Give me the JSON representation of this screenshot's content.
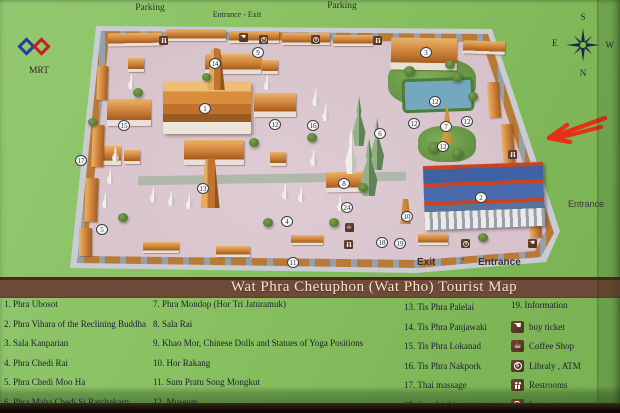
{
  "banner": {
    "title": "Wat Phra Chetuphon (Wat Pho) Tourist Map"
  },
  "map": {
    "labels": {
      "parking_left": "Parking",
      "entrance_exit_top": "Entrance - Exit",
      "parking_right": "Parking",
      "entrance_right": "Entrance",
      "exit_bottom": "Exit",
      "bottom_note": "7",
      "entrance_bottom": "Entrance",
      "mrt": "MRT"
    },
    "compass": {
      "top": "S",
      "left": "E",
      "right": "W",
      "bottom": "N"
    },
    "markers": [
      {
        "n": "1",
        "x": 205,
        "y": 108
      },
      {
        "n": "2",
        "x": 481,
        "y": 197
      },
      {
        "n": "3",
        "x": 426,
        "y": 52
      },
      {
        "n": "4",
        "x": 287,
        "y": 221
      },
      {
        "n": "5",
        "x": 102,
        "y": 229
      },
      {
        "n": "6",
        "x": 380,
        "y": 133
      },
      {
        "n": "7",
        "x": 446,
        "y": 126
      },
      {
        "n": "8",
        "x": 344,
        "y": 183
      },
      {
        "n": "9",
        "x": 258,
        "y": 52
      },
      {
        "n": "10",
        "x": 407,
        "y": 216
      },
      {
        "n": "11",
        "x": 293,
        "y": 262
      },
      {
        "n": "12",
        "x": 275,
        "y": 124
      },
      {
        "n": "12",
        "x": 435,
        "y": 101
      },
      {
        "n": "12",
        "x": 414,
        "y": 123
      },
      {
        "n": "12",
        "x": 467,
        "y": 121
      },
      {
        "n": "12",
        "x": 443,
        "y": 146
      },
      {
        "n": "13",
        "x": 203,
        "y": 188
      },
      {
        "n": "14",
        "x": 215,
        "y": 63
      },
      {
        "n": "15",
        "x": 124,
        "y": 125
      },
      {
        "n": "16",
        "x": 313,
        "y": 125
      },
      {
        "n": "17",
        "x": 81,
        "y": 160
      },
      {
        "n": "18",
        "x": 382,
        "y": 242
      },
      {
        "n": "19",
        "x": 400,
        "y": 243
      },
      {
        "n": "24",
        "x": 347,
        "y": 207
      }
    ],
    "icons": [
      {
        "type": "wc",
        "x": 163,
        "y": 40
      },
      {
        "type": "hand",
        "x": 243,
        "y": 37
      },
      {
        "type": "dollar",
        "x": 263,
        "y": 39
      },
      {
        "type": "dollar",
        "x": 315,
        "y": 39
      },
      {
        "type": "wc",
        "x": 377,
        "y": 40
      },
      {
        "type": "wc",
        "x": 512,
        "y": 154
      },
      {
        "type": "cup",
        "x": 349,
        "y": 227
      },
      {
        "type": "wc",
        "x": 348,
        "y": 244
      },
      {
        "type": "dollar",
        "x": 465,
        "y": 243
      },
      {
        "type": "hand",
        "x": 532,
        "y": 243
      }
    ]
  },
  "legend": {
    "col1": [
      "1. Phra Ubosot",
      "2. Phra Vihara of the Reclining Buddha",
      "3. Sala Kanparian",
      "4. Phra Chedi Rai",
      "5. Phra Chedi Moo Ha",
      "6. Phra Maha Chedi Si Ratchakarn"
    ],
    "col2": [
      "7. Phra Mondop (Hor Tri Jaturamuk)",
      "8. Sala Rai",
      "9. Khao Mor, Chinese Dolls and Statues of Yoga Positions",
      "10. Hor Rakang",
      "11. Sum Pratu Song Mongkut",
      "12. Museum"
    ],
    "col3": [
      "13. Tis Phra Palelai",
      "14. Tis Phra Panjawaki",
      "15. Tis Phra Lokanad",
      "16. Tis Phra Nakpork",
      "17. Thai massage",
      "18. free drinking water"
    ],
    "col4_first": "19.  Information",
    "col4_icons": [
      {
        "icon": "hand",
        "label": "buy ticket"
      },
      {
        "icon": "cup",
        "label": "Coffee Shop"
      },
      {
        "icon": "dollar",
        "label": "Libraly , ATM"
      },
      {
        "icon": "wc",
        "label": "Restrooms"
      },
      {
        "icon": "wifi",
        "label": "Internet center"
      }
    ]
  },
  "colors": {
    "bg_green": "#8ac263",
    "banner_brown": "#6f4a38",
    "ground_pink": "#d6c1ca",
    "roof_orange": "#cd8038",
    "blue_roof": "#4a6cae",
    "arrow_red": "#e63018"
  }
}
